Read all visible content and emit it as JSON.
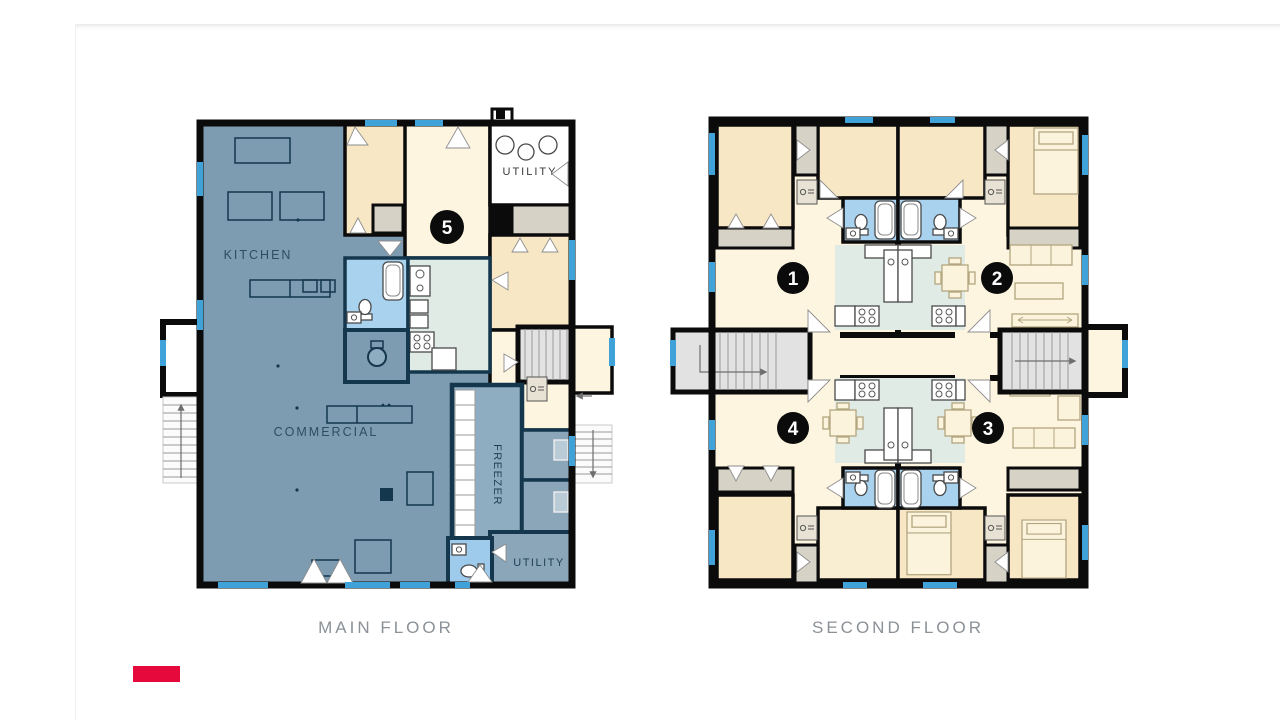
{
  "floor_plans": {
    "main": {
      "title": "MAIN FLOOR",
      "unit_badge": "5",
      "room_labels": {
        "kitchen": "KITCHEN",
        "commercial": "COMMERCIAL",
        "freezer": "FREEZER",
        "utility_top": "UTILITY",
        "utility_bottom": "UTILITY"
      }
    },
    "second": {
      "title": "SECOND FLOOR",
      "units": [
        {
          "number": "1"
        },
        {
          "number": "2"
        },
        {
          "number": "3"
        },
        {
          "number": "4"
        }
      ]
    }
  },
  "brand": {
    "bar_color": "#e5093c"
  },
  "colors": {
    "wall_black": "#0b0b0b",
    "interior_wall_navy": "#14374d",
    "commercial_blue": "#7d9cb2",
    "freezer_blue": "#8fadc0",
    "utility_gray_blue": "#8ba6b8",
    "bathroom_blue": "#a9d2ee",
    "kitchen_green": "#e0ebe5",
    "bedroom_tan": "#f7e7c5",
    "living_cream": "#fdf5e0",
    "closet_gray": "#d6d2c6",
    "window_blue": "#3fa3d9",
    "caption_gray": "#8b9197"
  }
}
